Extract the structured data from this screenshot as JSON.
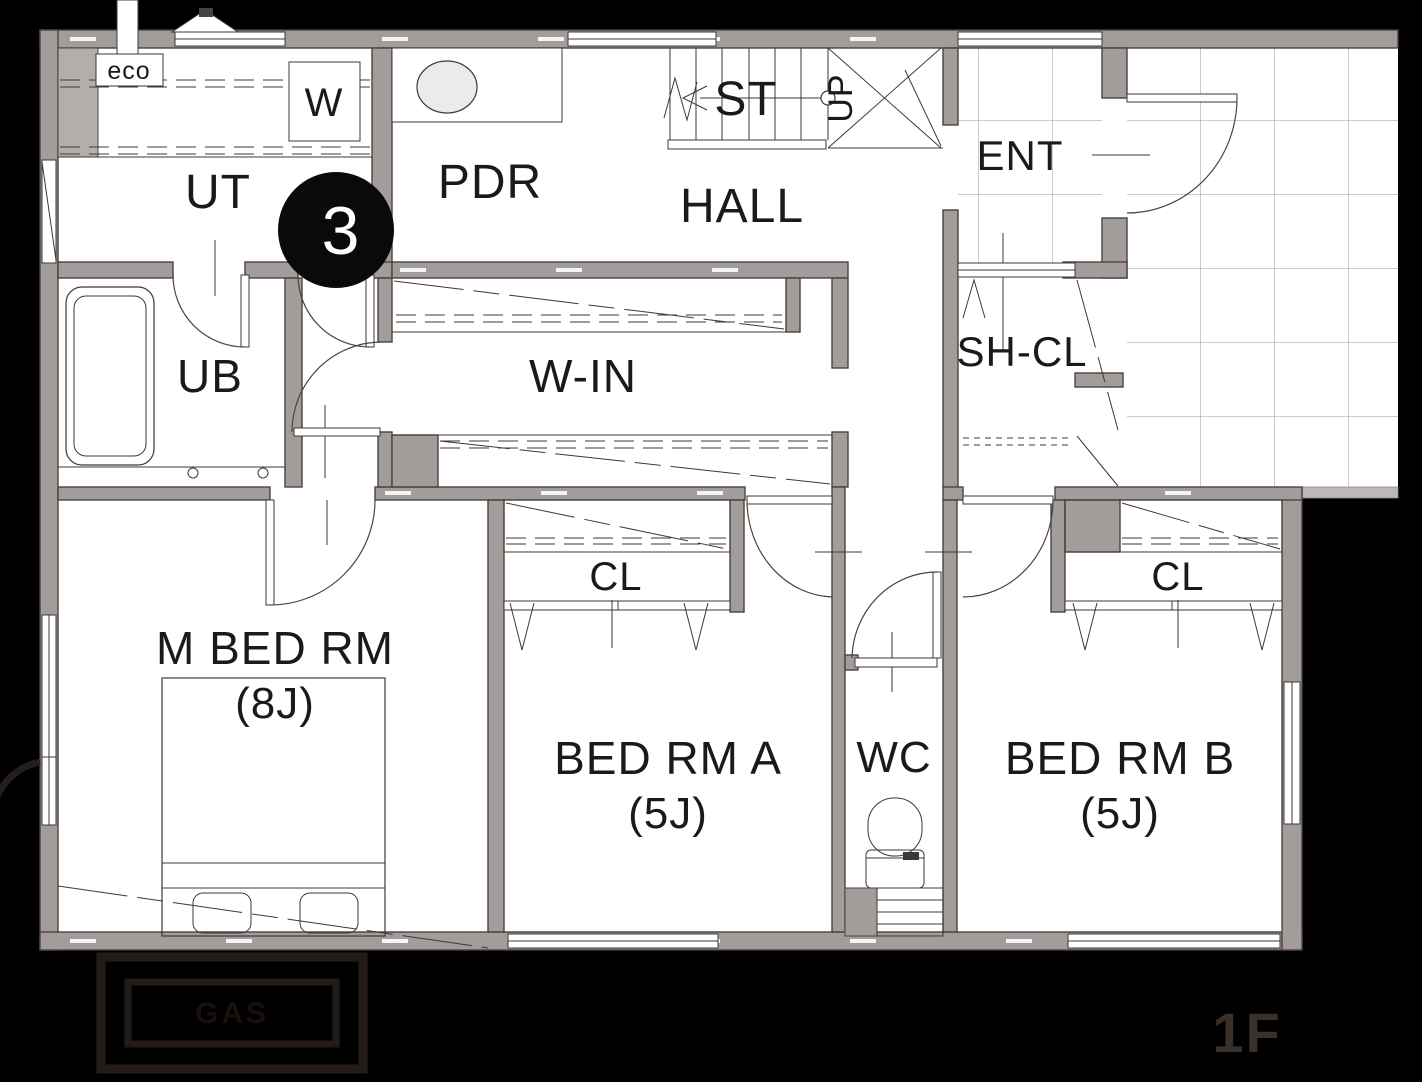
{
  "plan": {
    "floor_label": "1F",
    "badge": "3",
    "rooms": {
      "ut": "UT",
      "pdr": "PDR",
      "hall": "HALL",
      "stairs": "ST",
      "up": "UP",
      "ent": "ENT",
      "shoe_closet": "SH-CL",
      "bath": "UB",
      "walk_in": "W-IN",
      "closet_a": "CL",
      "closet_b": "CL",
      "wc": "WC",
      "master": {
        "name": "M BED RM",
        "size": "(8J)"
      },
      "bedroom_a": {
        "name": "BED RM A",
        "size": "(5J)"
      },
      "bedroom_b": {
        "name": "BED RM B",
        "size": "(5J)"
      }
    },
    "fixtures": {
      "eco": "eco",
      "washer": "W"
    },
    "exterior": {
      "meter": "GAS"
    }
  },
  "colors": {
    "bg": "#000000",
    "floor": "#ffffff",
    "wall": "#a29c9a",
    "wall-line": "#4b4341",
    "line": "#3e3836",
    "tile-line": "#9a9a9a",
    "badge-bg": "#0a0a0a",
    "badge-fg": "#ffffff",
    "floor-label": "#3a302b",
    "meter-label": "#1a0f0c",
    "fixture-fill": "#ebebeb"
  }
}
